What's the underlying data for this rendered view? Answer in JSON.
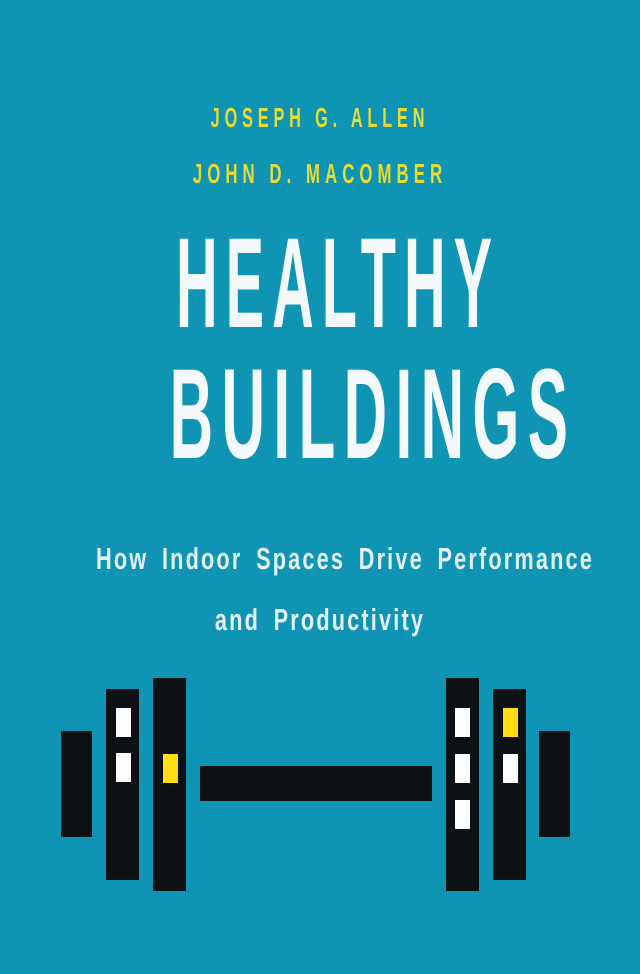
{
  "cover": {
    "authors": [
      "JOSEPH G. ALLEN",
      "JOHN D. MACOMBER"
    ],
    "title": {
      "line1": "HEALTHY",
      "line2": "BUILDINGS"
    },
    "subtitle": {
      "line1": "How Indoor Spaces Drive Performance",
      "line2": "and Productivity"
    },
    "colors": {
      "background": "#0f95b3",
      "author_text": "#e8dc33",
      "title_text": "#f4fafb",
      "subtitle_text": "#e2f0f4",
      "building_black": "#0b1114",
      "window_white": "#fefefe",
      "window_yellow": "#ffdf13"
    },
    "illustration": {
      "name": "dumbbell-made-of-buildings",
      "bar": {
        "x": 200,
        "y": 766,
        "w": 232,
        "h": 35
      },
      "buildings": [
        {
          "x": 61,
          "y": 731,
          "w": 31,
          "h": 106,
          "windows": []
        },
        {
          "x": 106,
          "y": 689,
          "w": 33,
          "h": 191,
          "windows": [
            {
              "x": 10,
              "y": 19,
              "w": 15,
              "h": 29,
              "color": "white"
            },
            {
              "x": 10,
              "y": 64,
              "w": 15,
              "h": 29,
              "color": "white"
            }
          ]
        },
        {
          "x": 153,
          "y": 678,
          "w": 33,
          "h": 213,
          "windows": [
            {
              "x": 10,
              "y": 76,
              "w": 15,
              "h": 29,
              "color": "yellow"
            }
          ]
        },
        {
          "x": 446,
          "y": 678,
          "w": 33,
          "h": 213,
          "windows": [
            {
              "x": 9,
              "y": 30,
              "w": 15,
              "h": 29,
              "color": "white"
            },
            {
              "x": 9,
              "y": 76,
              "w": 15,
              "h": 29,
              "color": "white"
            },
            {
              "x": 9,
              "y": 122,
              "w": 15,
              "h": 29,
              "color": "white"
            }
          ]
        },
        {
          "x": 493,
          "y": 689,
          "w": 33,
          "h": 191,
          "windows": [
            {
              "x": 10,
              "y": 19,
              "w": 15,
              "h": 29,
              "color": "yellow"
            },
            {
              "x": 10,
              "y": 65,
              "w": 15,
              "h": 29,
              "color": "white"
            }
          ]
        },
        {
          "x": 539,
          "y": 731,
          "w": 31,
          "h": 106,
          "windows": []
        }
      ]
    }
  }
}
